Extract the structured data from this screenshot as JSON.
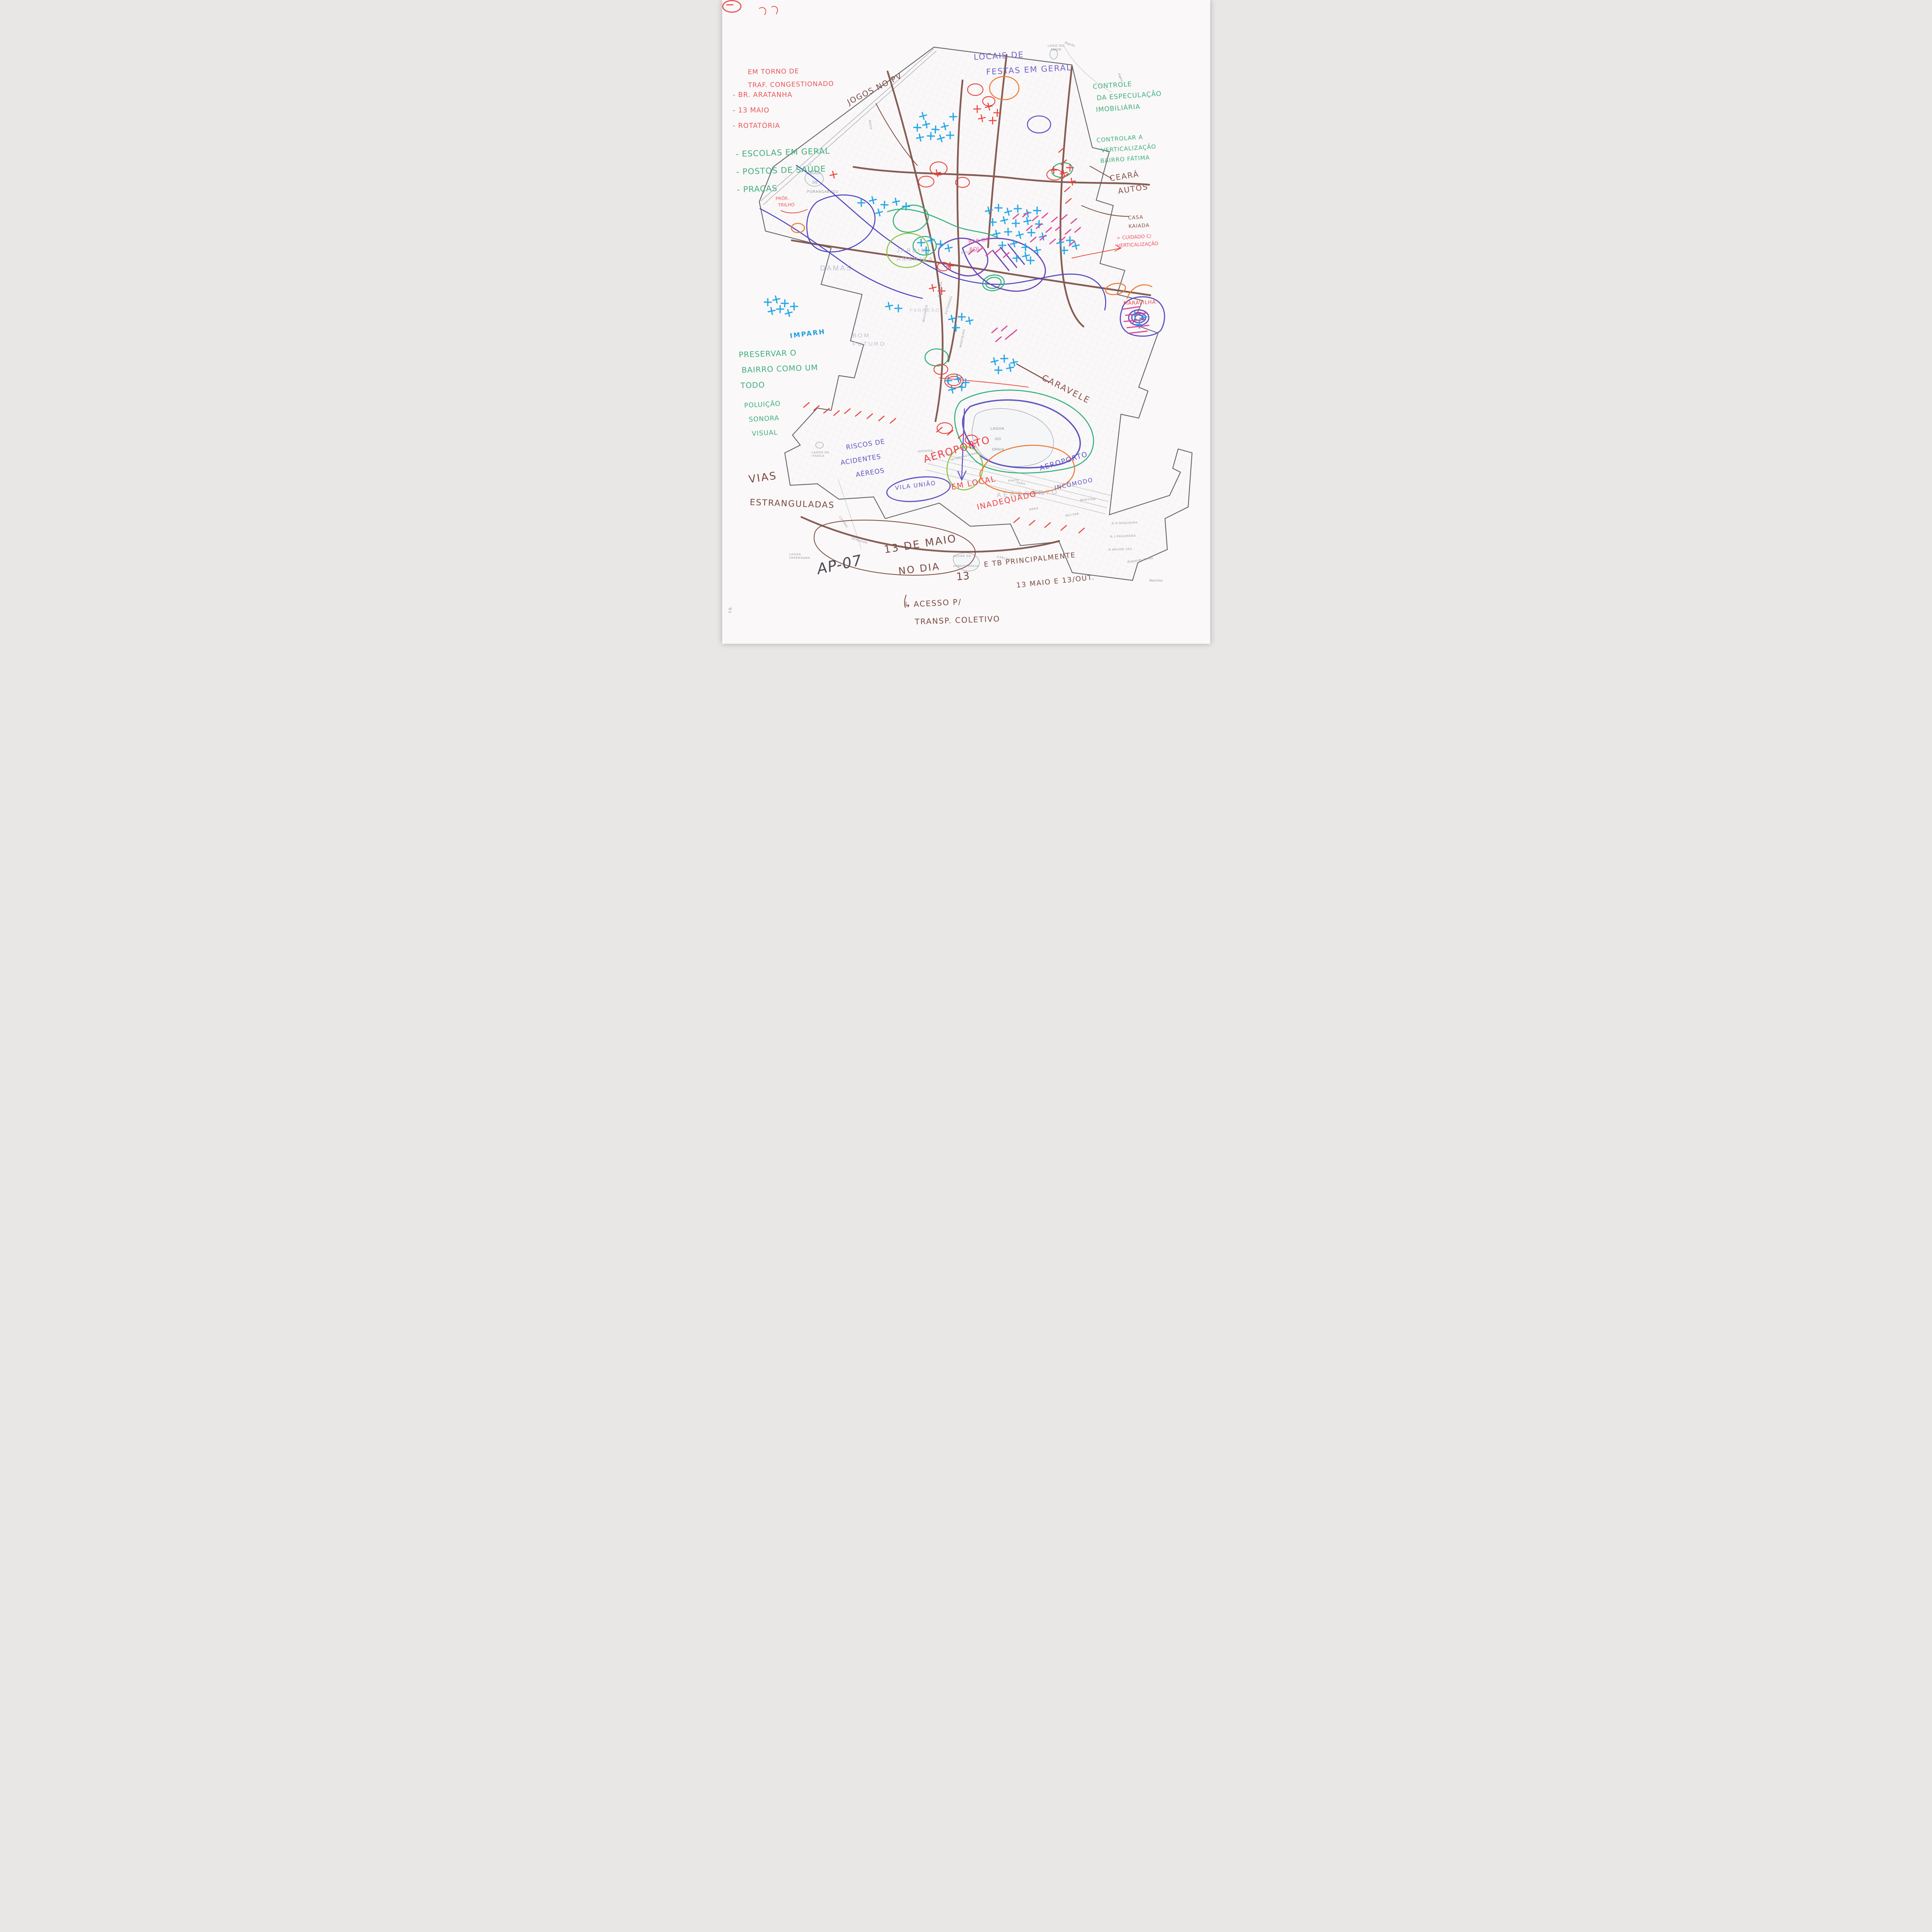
{
  "document": {
    "signature": "AP-07",
    "corner_mark": "F.B.",
    "paper_color": "#faf8f8"
  },
  "colors": {
    "red": "#e8484f",
    "green": "#3fae7e",
    "brown": "#7d4f47",
    "cyan": "#22a7e8",
    "purple": "#6a46b8",
    "blue_violet": "#5d55c4",
    "pink": "#e0459a",
    "orange": "#f07830",
    "lime": "#8ac43f"
  },
  "annotations": {
    "congestionado": {
      "lines": [
        "EM TORNO DE",
        "TRAF. CONGESTIONADO"
      ],
      "items": [
        "- BR. ARATANHA",
        "- 13 MAIO",
        "- ROTATÓRIA"
      ]
    },
    "jogos_no_pv": {
      "text": "JOGOS NO PV"
    },
    "locais_festas": {
      "lines": [
        "LOCAIS DE",
        "FESTAS EM GERAL"
      ]
    },
    "controle_especulacao": {
      "lines": [
        "CONTROLE",
        "DA ESPECULAÇÃO",
        "IMOBILIÁRIA"
      ]
    },
    "controlar_verticalizacao": {
      "lines": [
        "CONTROLAR A",
        "VERTICALIZAÇÃO",
        "BAIRRO FÁTIMA"
      ]
    },
    "ceara_autos": {
      "lines": [
        "CEARÁ",
        "AUTOS"
      ]
    },
    "casa_kaiada": {
      "lines": [
        "CASA",
        "KAIADA"
      ]
    },
    "cuidado_verticalizacao": {
      "arrow": "➢",
      "lines": [
        "CUIDADO C/",
        "VERTICALIZAÇÃO"
      ]
    },
    "equipamentos": {
      "items": [
        "- ESCOLAS EM GERAL",
        "- POSTOS DE SAÚDE",
        "- PRAÇAS"
      ]
    },
    "prox_trilho": {
      "lines": [
        "PRÓX.",
        "TRILHO"
      ]
    },
    "imparh": {
      "text": "IMPARH"
    },
    "preservar_bairro": {
      "lines": [
        "PRESERVAR O",
        "BAIRRO COMO UM",
        "TODO"
      ]
    },
    "poluicao": {
      "lines": [
        "POLUIÇÃO",
        "SONORA",
        "VISUAL"
      ]
    },
    "riscos_aereos": {
      "lines": [
        "RISCOS DE",
        "ACIDENTES",
        "AÉREOS"
      ]
    },
    "vila_uniao": {
      "text": "VILA UNIÃO"
    },
    "aeroporto_inadequado": {
      "lines": [
        "AEROPORTO",
        "EM LOCAL",
        "INADEQUADO"
      ]
    },
    "aeroporto_incomodo": {
      "lines": [
        "AEROPORTO",
        "INCÔMODO"
      ]
    },
    "caravele": {
      "text": "CARAVELE"
    },
    "maravilha": {
      "text": "MARAVILHA"
    },
    "bar_do_bola": {
      "lines": [
        "BAR DO",
        "BOLA"
      ]
    },
    "vias_estranguladas": {
      "lines": [
        "VIAS",
        "ESTRANGULADAS"
      ]
    },
    "treze_de_maio": {
      "lines": [
        "13 DE MAIO",
        "NO DIA"
      ],
      "number": "13"
    },
    "acesso_transporte": {
      "arrow": "↳",
      "lines": [
        "ACESSO P/",
        "TRANSP. COLETIVO"
      ]
    },
    "principalmente": {
      "lines": [
        "E TB PRINCIPALMENTE",
        "13 MAIO E 13/OUT."
      ]
    }
  },
  "map_labels": {
    "lago_do_amor": [
      "LAGO DO",
      "AMOR"
    ],
    "riacho": "Riacho",
    "pajeu": "Pajeú",
    "porangabucu": [
      "LAGOA",
      "DE",
      "PORANGABUÇU"
    ],
    "damas": "DAMAS",
    "jardim_america": [
      "JARDIM",
      "AMÉRICA"
    ],
    "bom_futuro": [
      "BOM",
      "FUTURO"
    ],
    "parreao": "PARREÃO",
    "aeroporto": "AEROPORTO",
    "lagoa_opaia": [
      "LAGOA",
      "DO",
      "OPAIA"
    ],
    "acude": [
      "AÇUDE DA",
      "SUBSISTÊNCIA"
    ],
    "lagoa_itaoca": [
      "LAGOA DA",
      "ITAOCA"
    ],
    "lagoa_taperoaba": [
      "LAGOA",
      "TAPEROABA"
    ],
    "martinho": "Martinho",
    "braco_rio": "Esquerdo do Rio",
    "streets": {
      "nogueira": "R.R.NOGUEIRA",
      "fagundes": "R.J.FAGUNDES",
      "major_vaz": "R.MAJOR VAZ",
      "militar": "MILITAR",
      "area": "ÁREA",
      "internacional": "INTERNACIONAL",
      "pinto": "PINTO",
      "avenida": "AVENIDA",
      "cabral": "CABRAL",
      "senador": "SENADOR",
      "eduardo": "EDUARDO",
      "carlos": "CARLOS",
      "joao": "JOÃO",
      "bosco": "BOSCO",
      "martins": "MARTINS",
      "mota": "MOTA",
      "monteiro": "MONTEIRO",
      "silveira": "SILVEIRA",
      "machado": "MACHADO",
      "guterres": "GUTERRES"
    }
  }
}
